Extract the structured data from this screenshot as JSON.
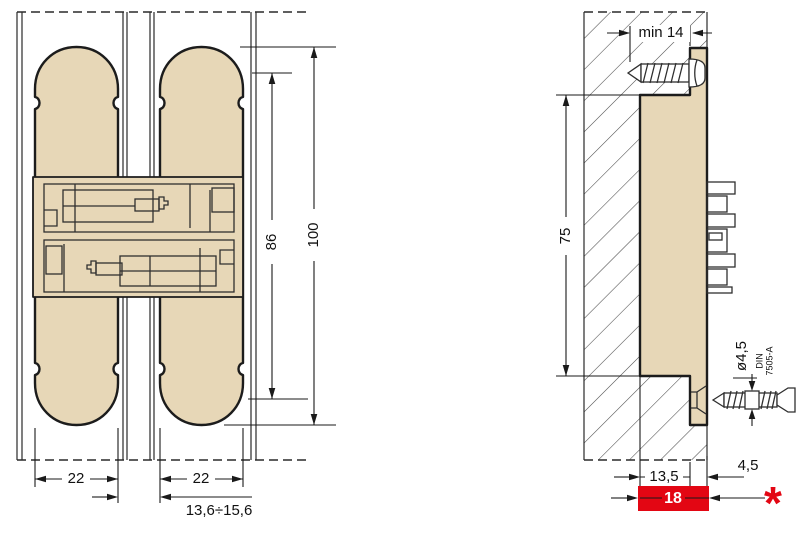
{
  "front_view": {
    "dim_width_left": "22",
    "dim_width_right": "22",
    "dim_gap_range": "13,6÷15,6",
    "dim_inner_height": "86",
    "dim_total_height": "100"
  },
  "side_view": {
    "dim_min_depth": "min 14",
    "dim_height": "75",
    "screw_diameter": "ø4,5",
    "screw_standard_line1": "DIN",
    "screw_standard_line2": "7505-A",
    "dim_body_depth": "13,5",
    "dim_flange_offset": "4,5",
    "dim_total_depth": "18",
    "footnote_marker": "*"
  },
  "colors": {
    "hinge_fill": "#e7d7b7",
    "outline": "#1c1c1c",
    "highlight_red": "#e30613"
  }
}
